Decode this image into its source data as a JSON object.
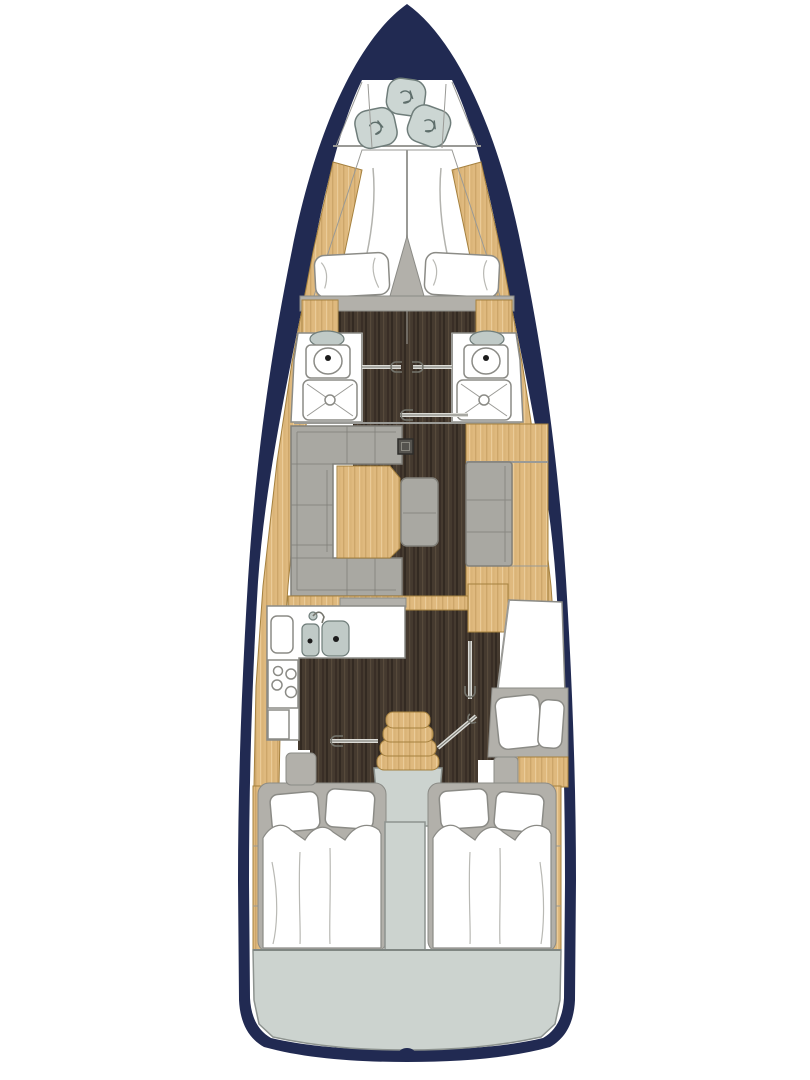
{
  "diagram": {
    "type": "yacht-interior-deck-plan",
    "orientation": "bow-up",
    "regions": [
      {
        "id": "hull",
        "kind": "outline"
      },
      {
        "id": "anchor-locker",
        "kind": "bow-locker",
        "rope_coils": 3
      },
      {
        "id": "forward-cabin",
        "kind": "cabin",
        "berth": "v-berth-double",
        "pillows": 2
      },
      {
        "id": "port-head",
        "kind": "bathroom",
        "fixtures": [
          "sink",
          "toilet",
          "shower-tray"
        ]
      },
      {
        "id": "starboard-head",
        "kind": "bathroom",
        "fixtures": [
          "sink",
          "toilet",
          "shower-tray"
        ]
      },
      {
        "id": "saloon",
        "kind": "living-area",
        "furniture": [
          "u-sofa",
          "table",
          "stool-bench",
          "mast-post",
          "sideboard",
          "settee"
        ]
      },
      {
        "id": "galley",
        "kind": "kitchen",
        "fixtures": [
          "worktop",
          "cutting-board",
          "double-sink",
          "faucet",
          "stove-4-burners",
          "cabinet"
        ]
      },
      {
        "id": "starboard-guest-cabin",
        "kind": "cabin",
        "berth": "single-longitudinal",
        "pillows": 2
      },
      {
        "id": "companionway",
        "kind": "stairs",
        "steps": 4
      },
      {
        "id": "port-aft-cabin",
        "kind": "cabin",
        "berth": "double",
        "pillows": 2
      },
      {
        "id": "starboard-aft-cabin",
        "kind": "cabin",
        "berth": "double",
        "pillows": 2
      },
      {
        "id": "engine-compartment",
        "kind": "technical"
      },
      {
        "id": "transom-deck",
        "kind": "stern-platform"
      }
    ],
    "door_count": 6
  },
  "colors": {
    "hull-navy": "#212a52",
    "interior-white": "#ffffff",
    "wood-light": "#dfb97e",
    "wood-grain": "#c29a5e",
    "wood-grain-light": "#ecd09f",
    "wood-edge": "#a5813f",
    "floor-dark": "#453a2f",
    "floor-grain-dark": "#332a22",
    "floor-grain-light": "#5a4c3d",
    "sofa-gray": "#a9a8a2",
    "sofa-seam": "#81807a",
    "frame-gray": "#b2b0aa",
    "deck-gray": "#ccd3cf",
    "deck-edge": "#8d938f",
    "fixture-gray": "#c0cac7",
    "fixture-edge": "#6f7d7a",
    "locker-gray": "#ccd6d3",
    "outline-gray": "#8b8b86",
    "wall-gray": "#9a9a96",
    "door-light": "#dcdcd7",
    "door-dark": "#75756d"
  }
}
